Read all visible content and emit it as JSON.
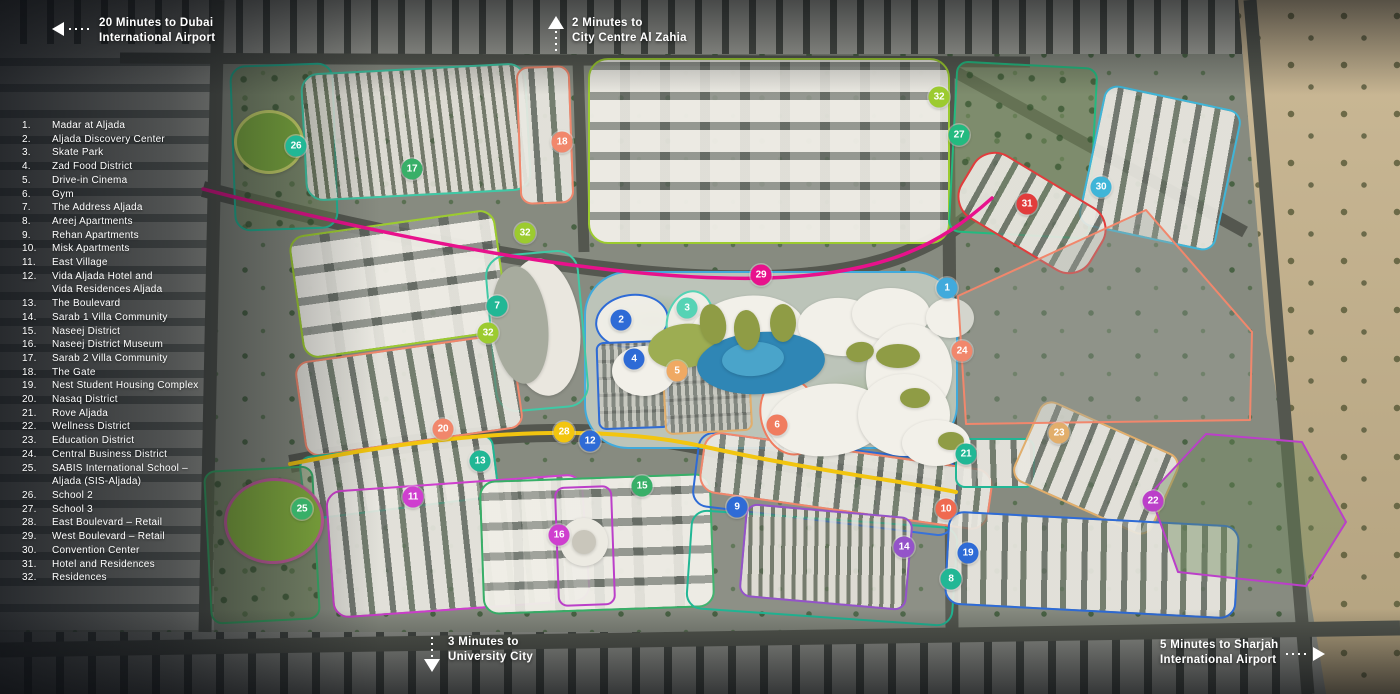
{
  "colors": {
    "blue": "#2E6BD6",
    "skyblue": "#41AADC",
    "mint": "#55D3B5",
    "teal": "#21B795",
    "tealgreen": "#23BA80",
    "green": "#38AF68",
    "aqua": "#3FC9A6",
    "yellowgreen": "#9CCB2F",
    "yellow": "#F2C50F",
    "lightorange": "#EFA963",
    "tan": "#E2AE6B",
    "salmon": "#F1876C",
    "salmonred": "#F07C5F",
    "vermilion": "#EF6A50",
    "red": "#E23C3C",
    "pink": "#E8118C",
    "magenta": "#CF3FCF",
    "violet": "#BB3FC9",
    "purple": "#9453C9",
    "cyan": "#3FB5D8",
    "road": "#54574F",
    "text": "#FFFFFF"
  },
  "legend": {
    "items": [
      {
        "num": "1.",
        "lines": [
          "Madar at Aljada"
        ]
      },
      {
        "num": "2.",
        "lines": [
          "Aljada Discovery Center"
        ]
      },
      {
        "num": "3.",
        "lines": [
          "Skate Park"
        ]
      },
      {
        "num": "4.",
        "lines": [
          "Zad Food District"
        ]
      },
      {
        "num": "5.",
        "lines": [
          "Drive-in Cinema"
        ]
      },
      {
        "num": "6.",
        "lines": [
          "Gym"
        ]
      },
      {
        "num": "7.",
        "lines": [
          "The Address Aljada"
        ]
      },
      {
        "num": "8.",
        "lines": [
          "Areej Apartments"
        ]
      },
      {
        "num": "9.",
        "lines": [
          "Rehan Apartments"
        ]
      },
      {
        "num": "10.",
        "lines": [
          "Misk Apartments"
        ]
      },
      {
        "num": "11.",
        "lines": [
          "East Village"
        ]
      },
      {
        "num": "12.",
        "lines": [
          "Vida Aljada Hotel and",
          "Vida Residences Aljada"
        ]
      },
      {
        "num": "13.",
        "lines": [
          "The Boulevard"
        ]
      },
      {
        "num": "14.",
        "lines": [
          "Sarab 1 Villa Community"
        ]
      },
      {
        "num": "15.",
        "lines": [
          "Naseej District"
        ]
      },
      {
        "num": "16.",
        "lines": [
          "Naseej District Museum"
        ]
      },
      {
        "num": "17.",
        "lines": [
          "Sarab 2 Villa Community"
        ]
      },
      {
        "num": "18.",
        "lines": [
          "The Gate"
        ]
      },
      {
        "num": "19.",
        "lines": [
          "Nest Student Housing Complex"
        ]
      },
      {
        "num": "20.",
        "lines": [
          "Nasaq District"
        ]
      },
      {
        "num": "21.",
        "lines": [
          "Rove Aljada"
        ]
      },
      {
        "num": "22.",
        "lines": [
          "Wellness District"
        ]
      },
      {
        "num": "23.",
        "lines": [
          "Education District"
        ]
      },
      {
        "num": "24.",
        "lines": [
          "Central Business District"
        ]
      },
      {
        "num": "25.",
        "lines": [
          "SABIS International School –",
          "Aljada (SIS-Aljada)"
        ]
      },
      {
        "num": "26.",
        "lines": [
          "School 2"
        ]
      },
      {
        "num": "27.",
        "lines": [
          "School 3"
        ]
      },
      {
        "num": "28.",
        "lines": [
          "East Boulevard – Retail"
        ]
      },
      {
        "num": "29.",
        "lines": [
          "West Boulevard – Retail"
        ]
      },
      {
        "num": "30.",
        "lines": [
          "Convention Center"
        ]
      },
      {
        "num": "31.",
        "lines": [
          "Hotel and Residences"
        ]
      },
      {
        "num": "32.",
        "lines": [
          "Residences"
        ]
      }
    ]
  },
  "annotations": [
    {
      "id": "dubai-airport",
      "direction": "left",
      "line1": "20 Minutes to Dubai",
      "line2": "International Airport"
    },
    {
      "id": "al-zahia",
      "direction": "up",
      "line1": "2 Minutes to",
      "line2": "City Centre Al Zahia"
    },
    {
      "id": "university-city",
      "direction": "down",
      "line1": "3 Minutes to",
      "line2": "University City"
    },
    {
      "id": "sharjah-airport",
      "direction": "right",
      "line1": "5 Minutes to Sharjah",
      "line2": "International Airport"
    }
  ],
  "markers": [
    {
      "num": "1",
      "x": 947,
      "y": 288,
      "c": "skyblue"
    },
    {
      "num": "2",
      "x": 621,
      "y": 320,
      "c": "blue"
    },
    {
      "num": "3",
      "x": 687,
      "y": 308,
      "c": "mint"
    },
    {
      "num": "4",
      "x": 634,
      "y": 359,
      "c": "blue"
    },
    {
      "num": "5",
      "x": 677,
      "y": 371,
      "c": "lightorange"
    },
    {
      "num": "6",
      "x": 777,
      "y": 425,
      "c": "salmonred"
    },
    {
      "num": "7",
      "x": 497,
      "y": 306,
      "c": "teal"
    },
    {
      "num": "8",
      "x": 951,
      "y": 579,
      "c": "teal"
    },
    {
      "num": "9",
      "x": 737,
      "y": 507,
      "c": "blue"
    },
    {
      "num": "10",
      "x": 946,
      "y": 509,
      "c": "vermilion"
    },
    {
      "num": "11",
      "x": 413,
      "y": 497,
      "c": "magenta"
    },
    {
      "num": "12",
      "x": 590,
      "y": 441,
      "c": "blue"
    },
    {
      "num": "13",
      "x": 480,
      "y": 461,
      "c": "teal"
    },
    {
      "num": "14",
      "x": 904,
      "y": 547,
      "c": "purple"
    },
    {
      "num": "15",
      "x": 642,
      "y": 486,
      "c": "green"
    },
    {
      "num": "16",
      "x": 559,
      "y": 535,
      "c": "magenta"
    },
    {
      "num": "17",
      "x": 412,
      "y": 169,
      "c": "green"
    },
    {
      "num": "18",
      "x": 562,
      "y": 142,
      "c": "salmon"
    },
    {
      "num": "19",
      "x": 968,
      "y": 553,
      "c": "blue"
    },
    {
      "num": "20",
      "x": 443,
      "y": 429,
      "c": "salmon"
    },
    {
      "num": "21",
      "x": 966,
      "y": 454,
      "c": "teal"
    },
    {
      "num": "22",
      "x": 1153,
      "y": 501,
      "c": "violet"
    },
    {
      "num": "23",
      "x": 1059,
      "y": 433,
      "c": "tan"
    },
    {
      "num": "24",
      "x": 962,
      "y": 351,
      "c": "salmon"
    },
    {
      "num": "25",
      "x": 302,
      "y": 509,
      "c": "green"
    },
    {
      "num": "26",
      "x": 296,
      "y": 146,
      "c": "teal"
    },
    {
      "num": "27",
      "x": 959,
      "y": 135,
      "c": "tealgreen"
    },
    {
      "num": "28",
      "x": 564,
      "y": 432,
      "c": "yellow"
    },
    {
      "num": "29",
      "x": 761,
      "y": 275,
      "c": "pink"
    },
    {
      "num": "30",
      "x": 1101,
      "y": 187,
      "c": "cyan"
    },
    {
      "num": "31",
      "x": 1027,
      "y": 204,
      "c": "red"
    },
    {
      "num": "32",
      "x": 939,
      "y": 97,
      "c": "yellowgreen"
    },
    {
      "num": "32",
      "x": 525,
      "y": 233,
      "c": "yellowgreen"
    },
    {
      "num": "32",
      "x": 488,
      "y": 333,
      "c": "yellowgreen"
    }
  ],
  "map": {
    "districts": [
      {
        "id": "school-2",
        "c": "teal",
        "x": 232,
        "y": 64,
        "w": 104,
        "h": 166,
        "r": "16px",
        "rot": -2,
        "pat": "p-park"
      },
      {
        "id": "sarab-2-villas",
        "c": "aqua",
        "x": 303,
        "y": 68,
        "w": 226,
        "h": 128,
        "r": "18px",
        "rot": -3,
        "pat": "p-villas"
      },
      {
        "id": "the-gate",
        "c": "salmon",
        "x": 518,
        "y": 66,
        "w": 54,
        "h": 138,
        "r": "12px",
        "rot": -2,
        "pat": "p-blocks"
      },
      {
        "id": "residences-north",
        "c": "yellowgreen",
        "x": 588,
        "y": 58,
        "w": 362,
        "h": 186,
        "r": "20px",
        "rot": 0,
        "pat": "p-courtyard"
      },
      {
        "id": "school-3",
        "c": "tealgreen",
        "x": 952,
        "y": 64,
        "w": 142,
        "h": 172,
        "r": "12px",
        "rot": 3,
        "pat": "p-park"
      },
      {
        "id": "convention-center",
        "c": "cyan",
        "x": 1090,
        "y": 96,
        "w": 140,
        "h": 144,
        "r": "14px",
        "rot": 12,
        "pat": "p-blocks"
      },
      {
        "id": "hotel-residences",
        "c": "red",
        "x": 956,
        "y": 176,
        "w": 152,
        "h": 74,
        "r": "26px",
        "rot": 31,
        "pat": "p-blocks"
      },
      {
        "id": "madar-park",
        "c": "skyblue",
        "x": 584,
        "y": 271,
        "w": 374,
        "h": 178,
        "r": "44px",
        "rot": 0,
        "pat": "p-parkpale"
      },
      {
        "id": "residences-mid",
        "c": "yellowgreen",
        "x": 295,
        "y": 222,
        "w": 208,
        "h": 124,
        "r": "16px",
        "rot": -8,
        "pat": "p-courtyard"
      },
      {
        "id": "the-address",
        "c": "aqua",
        "x": 490,
        "y": 252,
        "w": 94,
        "h": 158,
        "r": "22px",
        "rot": -5,
        "pat": "p-none"
      },
      {
        "id": "nasaq",
        "c": "salmon",
        "x": 299,
        "y": 347,
        "w": 220,
        "h": 96,
        "r": "14px",
        "rot": -8,
        "pat": "p-blocks"
      },
      {
        "id": "the-boulevard",
        "c": "teal",
        "x": 301,
        "y": 445,
        "w": 196,
        "h": 64,
        "r": "12px",
        "rot": -7,
        "pat": "p-blocks"
      },
      {
        "id": "sabis-school",
        "c": "green",
        "x": 207,
        "y": 468,
        "w": 110,
        "h": 154,
        "r": "12px",
        "rot": -3,
        "pat": "p-park"
      },
      {
        "id": "east-village",
        "c": "magenta",
        "x": 329,
        "y": 482,
        "w": 258,
        "h": 128,
        "r": "16px",
        "rot": -4,
        "pat": "p-blocks"
      },
      {
        "id": "naseej",
        "c": "green",
        "x": 481,
        "y": 477,
        "w": 232,
        "h": 134,
        "r": "16px",
        "rot": -2,
        "pat": "p-courtyard"
      },
      {
        "id": "naseej-museum",
        "c": "violet",
        "x": 556,
        "y": 486,
        "w": 58,
        "h": 120,
        "r": "10px",
        "rot": -2,
        "pat": "p-none"
      },
      {
        "id": "rehan",
        "c": "blue",
        "x": 694,
        "y": 446,
        "w": 264,
        "h": 76,
        "r": "16px",
        "rot": 7,
        "pat": "p-none"
      },
      {
        "id": "areej",
        "c": "teal",
        "x": 688,
        "y": 518,
        "w": 268,
        "h": 100,
        "r": "16px",
        "rot": 4,
        "pat": "p-none"
      },
      {
        "id": "misk",
        "c": "salmon",
        "x": 700,
        "y": 450,
        "w": 292,
        "h": 62,
        "r": "18px",
        "rot": 8,
        "pat": "p-blocks"
      },
      {
        "id": "sarab-1-villas",
        "c": "purple",
        "x": 742,
        "y": 510,
        "w": 168,
        "h": 94,
        "r": "12px",
        "rot": 5,
        "pat": "p-villas"
      },
      {
        "id": "rove-aljada",
        "c": "teal",
        "x": 955,
        "y": 438,
        "w": 80,
        "h": 50,
        "r": "10px",
        "rot": 0,
        "pat": "p-blocks"
      },
      {
        "id": "education",
        "c": "tan",
        "x": 1020,
        "y": 424,
        "w": 152,
        "h": 88,
        "r": "14px",
        "rot": 24,
        "pat": "p-blocks"
      },
      {
        "id": "nest-student",
        "c": "blue",
        "x": 946,
        "y": 518,
        "w": 292,
        "h": 94,
        "r": "16px",
        "rot": 3,
        "pat": "p-blocks"
      },
      {
        "id": "discovery-center",
        "c": "blue",
        "x": 595,
        "y": 294,
        "w": 74,
        "h": 54,
        "r": "50%",
        "rot": -8,
        "pat": "p-white"
      },
      {
        "id": "skate-park",
        "c": "mint",
        "x": 666,
        "y": 290,
        "w": 48,
        "h": 64,
        "r": "50%",
        "rot": 12,
        "pat": "p-white"
      },
      {
        "id": "zad-food",
        "c": "blue",
        "x": 597,
        "y": 341,
        "w": 72,
        "h": 88,
        "r": "8px",
        "rot": -2,
        "pat": "p-parking"
      },
      {
        "id": "drive-in-cinema",
        "c": "tan",
        "x": 663,
        "y": 347,
        "w": 88,
        "h": 86,
        "r": "8px",
        "rot": -3,
        "pat": "p-parking"
      },
      {
        "id": "gym",
        "c": "salmonred",
        "x": 760,
        "y": 376,
        "w": 60,
        "h": 80,
        "r": "50%",
        "rot": -14,
        "pat": "p-white"
      }
    ],
    "polygons": [
      {
        "id": "central-business-district",
        "c": "salmon",
        "fill": "rgba(158,163,156,0.35)",
        "points": "958,296 1146,210 1252,332 1250,420 966,424"
      },
      {
        "id": "wellness-district",
        "c": "violet",
        "fill": "rgba(106,136,86,0.4)",
        "points": "1150,494 1206,434 1302,442 1346,522 1306,586 1178,572"
      }
    ],
    "roads": [
      {
        "d": "M 120 58 L 1030 62",
        "w": 11
      },
      {
        "d": "M 218 0 L 205 632",
        "w": 13
      },
      {
        "d": "M 578 60 L 584 252",
        "w": 11
      },
      {
        "d": "M 948 64 L 952 628",
        "w": 13
      },
      {
        "d": "M 952 70 L 1245 232",
        "w": 12
      },
      {
        "d": "M 1250 0 L 1308 694",
        "w": 13
      },
      {
        "d": "M 0 650 L 1400 628",
        "w": 15
      },
      {
        "d": "M 203 189 C 430 248 630 282 768 278 C 885 274 940 245 992 198",
        "w": 16
      },
      {
        "d": "M 290 464 C 460 430 600 423 706 447 C 810 470 895 480 956 492",
        "w": 18
      }
    ],
    "routes": [
      {
        "id": "west-boulevard-line",
        "c": "pink",
        "d": "M 203 189 C 430 248 630 282 768 278 C 885 274 940 245 992 198",
        "w": 3.5
      },
      {
        "id": "east-boulevard-line",
        "c": "yellow",
        "d": "M 290 464 C 460 430 600 423 706 447 C 810 470 895 480 956 492",
        "w": 4
      }
    ],
    "decor": [
      {
        "x": 688,
        "y": 296,
        "w": 118,
        "h": 78,
        "rot": -8,
        "fill": "#f2f0e9"
      },
      {
        "x": 798,
        "y": 298,
        "w": 86,
        "h": 58,
        "rot": 4,
        "fill": "#f2f0e9"
      },
      {
        "x": 852,
        "y": 288,
        "w": 78,
        "h": 52,
        "rot": 0,
        "fill": "#f2f0e9"
      },
      {
        "x": 866,
        "y": 324,
        "w": 86,
        "h": 98,
        "rot": 8,
        "fill": "#f2f0e9"
      },
      {
        "x": 612,
        "y": 346,
        "w": 64,
        "h": 50,
        "rot": 0,
        "fill": "#f2f0e9"
      },
      {
        "x": 768,
        "y": 384,
        "w": 120,
        "h": 72,
        "rot": -6,
        "fill": "#f2f0e9"
      },
      {
        "x": 858,
        "y": 374,
        "w": 92,
        "h": 82,
        "rot": 0,
        "fill": "#f2f0e9"
      },
      {
        "x": 902,
        "y": 420,
        "w": 68,
        "h": 46,
        "rot": 0,
        "fill": "#f2f0e9"
      },
      {
        "x": 926,
        "y": 298,
        "w": 48,
        "h": 40,
        "rot": 0,
        "fill": "#f2f0e9"
      },
      {
        "x": 648,
        "y": 324,
        "w": 72,
        "h": 44,
        "rot": -8,
        "fill": "#9dad52"
      },
      {
        "x": 697,
        "y": 332,
        "w": 128,
        "h": 62,
        "rot": -4,
        "fill": "#2f86b5"
      },
      {
        "x": 722,
        "y": 342,
        "w": 62,
        "h": 34,
        "rot": -4,
        "fill": "#4aa4ca"
      },
      {
        "x": 700,
        "y": 304,
        "w": 26,
        "h": 40,
        "rot": -10,
        "fill": "#8f9c45"
      },
      {
        "x": 734,
        "y": 310,
        "w": 26,
        "h": 40,
        "rot": -5,
        "fill": "#8f9c45"
      },
      {
        "x": 770,
        "y": 304,
        "w": 26,
        "h": 38,
        "rot": 0,
        "fill": "#8f9c45"
      },
      {
        "x": 876,
        "y": 344,
        "w": 44,
        "h": 24,
        "rot": 0,
        "fill": "#8f9c45"
      },
      {
        "x": 846,
        "y": 342,
        "w": 28,
        "h": 20,
        "rot": -10,
        "fill": "#8f9c45"
      },
      {
        "x": 900,
        "y": 388,
        "w": 30,
        "h": 20,
        "rot": 0,
        "fill": "#8f9c45"
      },
      {
        "x": 938,
        "y": 432,
        "w": 26,
        "h": 18,
        "rot": 0,
        "fill": "#8f9c45"
      },
      {
        "x": 234,
        "y": 110,
        "w": 64,
        "h": 58,
        "rot": 0,
        "fill": "#7fae3f",
        "ring": "#cdd96b"
      },
      {
        "x": 224,
        "y": 478,
        "w": 94,
        "h": 80,
        "rot": -4,
        "fill": "#86b23f",
        "ring": "#c75f9f"
      },
      {
        "x": 506,
        "y": 258,
        "w": 74,
        "h": 138,
        "rot": -6,
        "fill": "#eae7df"
      },
      {
        "x": 492,
        "y": 266,
        "w": 56,
        "h": 118,
        "rot": -6,
        "fill": "#a7ab9e"
      },
      {
        "x": 560,
        "y": 518,
        "w": 48,
        "h": 48,
        "rot": 0,
        "fill": "#eceae2"
      },
      {
        "x": 572,
        "y": 530,
        "w": 24,
        "h": 24,
        "rot": 0,
        "fill": "#c9c6bb"
      }
    ]
  }
}
